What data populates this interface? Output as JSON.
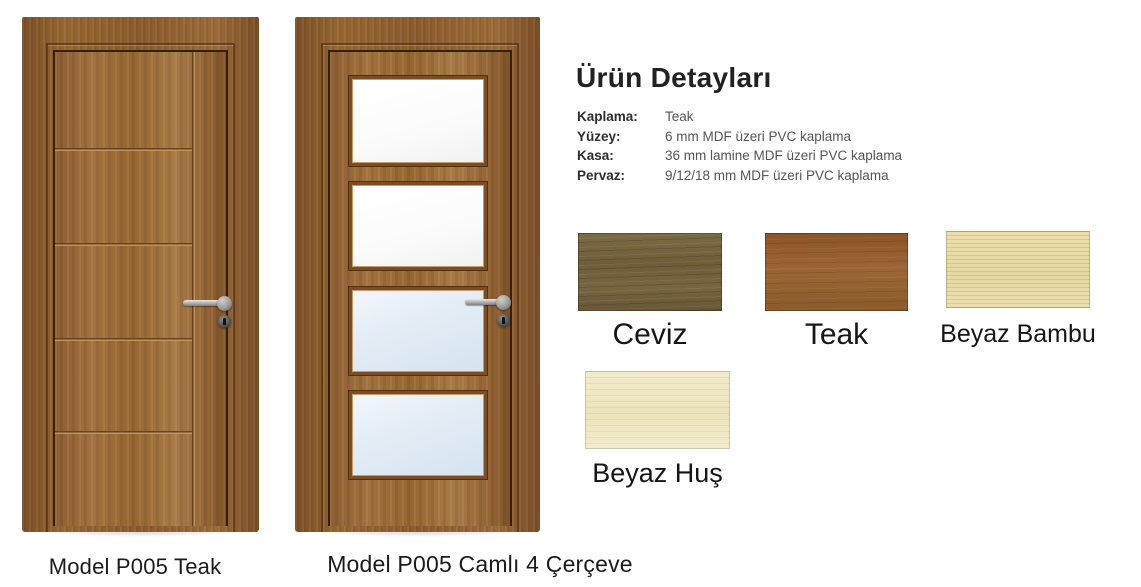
{
  "doors": [
    {
      "caption": "Model P005 Teak",
      "type": "solid panel door with 4 horizontal grooves",
      "finish": "Teak"
    },
    {
      "caption": "Model P005 Camlı 4 Çerçeve",
      "type": "door with 4 glass frames",
      "finish": "Teak"
    }
  ],
  "details": {
    "title": "Ürün Detayları",
    "rows": [
      {
        "label": "Kaplama:",
        "value": "Teak"
      },
      {
        "label": "Yüzey:",
        "value": "6 mm MDF üzeri PVC kaplama"
      },
      {
        "label": "Kasa:",
        "value": "36 mm lamine MDF üzeri PVC kaplama"
      },
      {
        "label": "Pervaz:",
        "value": "9/12/18 mm MDF üzeri PVC kaplama"
      }
    ]
  },
  "swatches": [
    {
      "name": "Ceviz",
      "color": "#6f5d39"
    },
    {
      "name": "Teak",
      "color": "#95602f"
    },
    {
      "name": "Beyaz Bambu",
      "color": "#e8daa5"
    },
    {
      "name": "Beyaz Huş",
      "color": "#f0e8c6"
    }
  ],
  "colors": {
    "door_leaf": "#9a6b3c",
    "door_casing": "#8a5b2d",
    "glass_clear": "#fbfbfb",
    "glass_blue": "#dde9f3",
    "text": "#1b1b1b"
  }
}
